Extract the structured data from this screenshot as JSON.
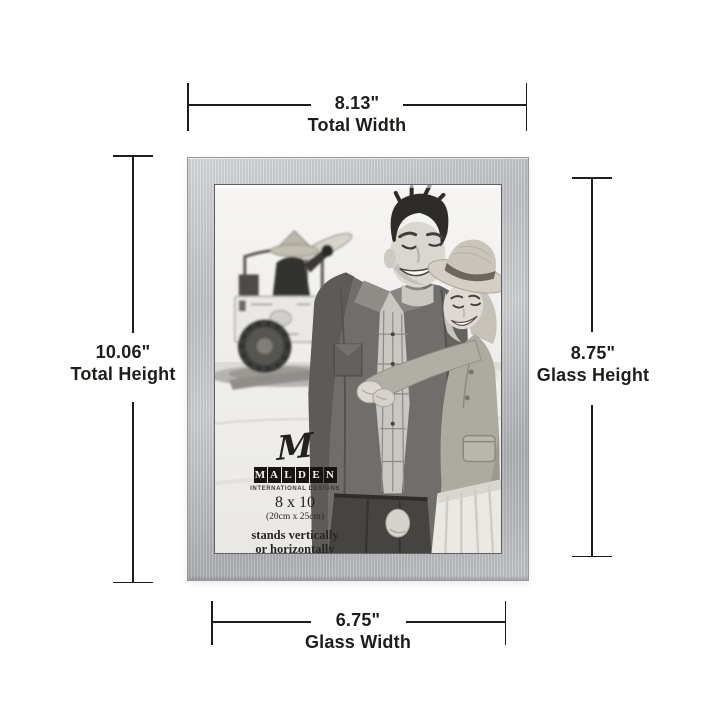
{
  "dimensions": {
    "total_width": {
      "value": "8.13\"",
      "label": "Total Width"
    },
    "total_height": {
      "value": "10.06\"",
      "label": "Total Height"
    },
    "glass_height": {
      "value": "8.75\"",
      "label": "Glass Height"
    },
    "glass_width": {
      "value": "6.75\"",
      "label": "Glass Width"
    }
  },
  "frame_label": {
    "monogram": "M",
    "brand_letters": [
      "M",
      "A",
      "L",
      "D",
      "E",
      "N"
    ],
    "tagline": "INTERNATIONAL DESIGNS",
    "size": "8 x 10",
    "size_metric": "(20cm x 25cm)",
    "orientation_line1": "stands vertically",
    "orientation_line2": "or horizontally"
  },
  "colors": {
    "background": "#ffffff",
    "dimension_ink": "#1d1d1b",
    "frame_silver": "#bfc1c4",
    "frame_silver_light": "#d8dadc",
    "frame_silver_dark": "#aeb0b3",
    "label_tile": "#161513",
    "photo_sky": "#f5f4f2",
    "photo_sand": "#efeeeb"
  }
}
